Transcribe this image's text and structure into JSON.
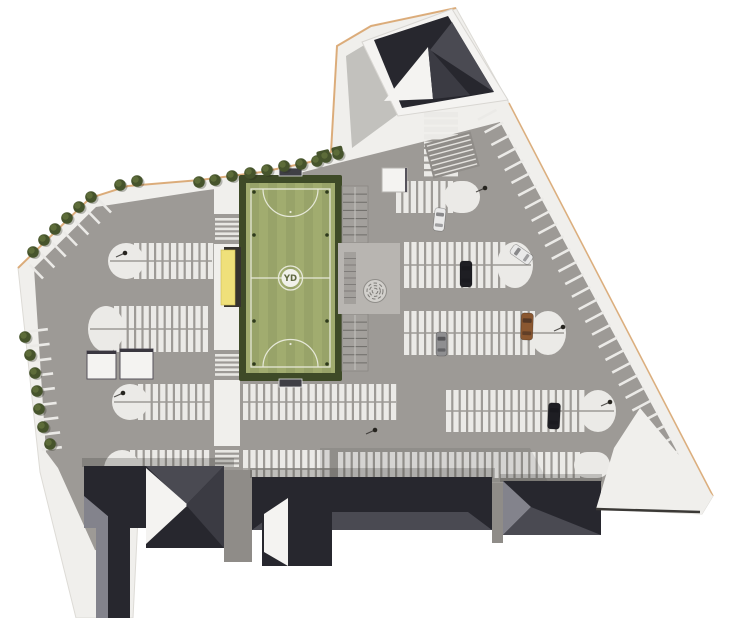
{
  "meta": {
    "description": "aerial-site-plan-rendering",
    "canvas_w": 730,
    "canvas_h": 618
  },
  "logo": {
    "text": "YD"
  },
  "palette": {
    "bg": "#ffffff",
    "sidewalk": "#f0efec",
    "asphalt": "#9d9a96",
    "asphaltDark": "#8f8c88",
    "stall": "#ebeae7",
    "fieldBorder": "#3e4a27",
    "pitch": "#a1ac6f",
    "pitchLine": "#e6e8d8",
    "treeDark": "#46542c",
    "treeLight": "#5d6c39",
    "yellow": "#efe07a",
    "canopyShadow": "#35322e",
    "roofDark": "#27272e",
    "roofMid": "#4a4a52",
    "roofDeep": "#3b3b43",
    "roofLight": "#83838c",
    "wallWhite": "#f4f3f1",
    "plaza": "#b8b5b1",
    "bleacher": "#a3a09c",
    "bleacherLine": "#6e6c68",
    "edgeTan": "#d9a268",
    "carWhite": "#e9e9e9",
    "carBlack": "#1e1e23",
    "carGray": "#8f8f91",
    "carBrown": "#8a5730",
    "pole": "#26241f"
  },
  "site": {
    "outline": [
      [
        337,
        46
      ],
      [
        371,
        26
      ],
      [
        456,
        8
      ],
      [
        509,
        103
      ],
      [
        713,
        496
      ],
      [
        702,
        514
      ],
      [
        596,
        509
      ],
      [
        332,
        498
      ],
      [
        140,
        477
      ],
      [
        133,
        618
      ],
      [
        76,
        618
      ],
      [
        40,
        472
      ],
      [
        18,
        268
      ],
      [
        90,
        198
      ],
      [
        128,
        186
      ],
      [
        200,
        180
      ],
      [
        262,
        172
      ],
      [
        310,
        162
      ],
      [
        331,
        152
      ]
    ],
    "asphalt": [
      [
        34,
        268
      ],
      [
        96,
        207
      ],
      [
        200,
        191
      ],
      [
        262,
        183
      ],
      [
        334,
        164
      ],
      [
        350,
        160
      ],
      [
        430,
        140
      ],
      [
        500,
        122
      ],
      [
        688,
        472
      ],
      [
        688,
        492
      ],
      [
        336,
        487
      ],
      [
        142,
        466
      ],
      [
        130,
        472
      ],
      [
        126,
        555
      ],
      [
        95,
        550
      ],
      [
        58,
        468
      ],
      [
        46,
        452
      ]
    ],
    "tan_edge_a": [
      [
        18,
        268
      ],
      [
        90,
        198
      ],
      [
        128,
        186
      ],
      [
        200,
        180
      ],
      [
        262,
        172
      ],
      [
        310,
        162
      ],
      [
        331,
        152
      ],
      [
        337,
        46
      ],
      [
        371,
        26
      ],
      [
        456,
        8
      ]
    ],
    "tan_edge_b": [
      [
        509,
        103
      ],
      [
        713,
        496
      ]
    ],
    "corner_wedge": [
      [
        640,
        408
      ],
      [
        713,
        496
      ],
      [
        702,
        514
      ],
      [
        596,
        509
      ],
      [
        614,
        448
      ]
    ],
    "wedge_line": [
      [
        596,
        509
      ],
      [
        700,
        512
      ]
    ]
  },
  "field": {
    "fence": [
      239,
      175,
      103,
      206
    ],
    "pitch": [
      246,
      183,
      89,
      190
    ],
    "bounds": [
      251,
      189,
      79,
      178
    ],
    "half_y": 278,
    "center": [
      290.5,
      278
    ],
    "center_r": 12,
    "logo_r": 9,
    "arc_r": 27.5,
    "goal_north": [
      279,
      168,
      23,
      8
    ],
    "goal_south": [
      279,
      379,
      23,
      8
    ],
    "spots": [
      [
        290.5,
        212
      ],
      [
        290.5,
        344
      ]
    ],
    "light_dots": [
      [
        254,
        192
      ],
      [
        327,
        192
      ],
      [
        254,
        235
      ],
      [
        327,
        235
      ],
      [
        254,
        321
      ],
      [
        327,
        321
      ],
      [
        254,
        364
      ],
      [
        327,
        364
      ]
    ]
  },
  "amenities": {
    "canopy_shadow": [
      224,
      247,
      17,
      60
    ],
    "canopy": [
      221,
      250,
      14,
      55
    ],
    "bleachers": [
      [
        342,
        186,
        26,
        57
      ],
      [
        342,
        314,
        26,
        57
      ]
    ],
    "plaza": [
      338,
      243,
      62,
      71
    ],
    "plaza_steps": [
      344,
      252,
      12,
      52
    ],
    "spiral": {
      "cx": 375,
      "cy": 291,
      "r": 11.5
    },
    "kiosks": [
      [
        87,
        351,
        29,
        28
      ],
      [
        120,
        349,
        33,
        30
      ]
    ],
    "field_kiosk": [
      382,
      168,
      25,
      24
    ],
    "hedges": [
      [
        316,
        152,
        13,
        7
      ],
      [
        331,
        148,
        11,
        6
      ]
    ]
  },
  "walkway": {
    "rect": [
      214,
      184,
      26,
      290
    ],
    "aisle_gaps": [
      [
        214,
        214,
        26,
        30
      ],
      [
        214,
        350,
        26,
        30
      ],
      [
        214,
        446,
        26,
        28
      ]
    ],
    "crosswalks": [
      [
        215,
        218,
        24,
        5
      ],
      [
        215,
        354,
        24,
        5
      ],
      [
        215,
        450,
        24,
        4
      ]
    ]
  },
  "parking": {
    "bands": [
      {
        "x": 108,
        "y": 243,
        "w": 106,
        "h": 36,
        "round": "left",
        "rows": 2
      },
      {
        "x": 88,
        "y": 306,
        "w": 126,
        "h": 46,
        "round": "left",
        "rows": 2
      },
      {
        "x": 112,
        "y": 384,
        "w": 102,
        "h": 36,
        "round": "left",
        "rows": 2
      },
      {
        "x": 241,
        "y": 384,
        "w": 157,
        "h": 36,
        "round": "none",
        "rows": 2
      },
      {
        "x": 104,
        "y": 450,
        "w": 110,
        "h": 38,
        "round": "left",
        "rows": 2
      },
      {
        "x": 241,
        "y": 450,
        "w": 91,
        "h": 38,
        "round": "none",
        "rows": 2
      },
      {
        "x": 336,
        "y": 452,
        "w": 274,
        "h": 26,
        "round": "right",
        "rows": 1
      },
      {
        "x": 394,
        "y": 181,
        "w": 86,
        "h": 32,
        "round": "right",
        "rows": 1
      },
      {
        "x": 402,
        "y": 242,
        "w": 131,
        "h": 46,
        "round": "right",
        "rows": 2
      },
      {
        "x": 402,
        "y": 311,
        "w": 164,
        "h": 44,
        "round": "right",
        "rows": 2
      },
      {
        "x": 444,
        "y": 390,
        "w": 172,
        "h": 42,
        "round": "right",
        "rows": 2
      },
      {
        "x": 424,
        "y": 112,
        "w": 34,
        "h": 66,
        "round": "none",
        "rows": 1,
        "dir": "v"
      }
    ],
    "edge_strips": [
      {
        "start": [
          500,
          108
        ],
        "end": [
          688,
          462
        ],
        "count": 29,
        "len": 21,
        "inset": 4
      },
      {
        "start": [
          27,
          262
        ],
        "end": [
          95,
          196
        ],
        "count": 7,
        "len": 19,
        "inset": 4
      },
      {
        "start": [
          24,
          332
        ],
        "end": [
          38,
          450
        ],
        "count": 9,
        "len": 20,
        "inset": 4
      }
    ]
  },
  "trees": [
    [
      33,
      252
    ],
    [
      44,
      240
    ],
    [
      55,
      229
    ],
    [
      67,
      218
    ],
    [
      79,
      207
    ],
    [
      91,
      197
    ],
    [
      120,
      185
    ],
    [
      137,
      181
    ],
    [
      199,
      182
    ],
    [
      215,
      180
    ],
    [
      232,
      176
    ],
    [
      250,
      173
    ],
    [
      267,
      170
    ],
    [
      284,
      166
    ],
    [
      301,
      164
    ],
    [
      317,
      161
    ],
    [
      326,
      157
    ],
    [
      338,
      154
    ],
    [
      25,
      337
    ],
    [
      30,
      355
    ],
    [
      35,
      373
    ],
    [
      37,
      391
    ],
    [
      39,
      409
    ],
    [
      43,
      427
    ],
    [
      50,
      444
    ]
  ],
  "poles": [
    [
      125,
      253
    ],
    [
      123,
      393
    ],
    [
      485,
      188
    ],
    [
      563,
      327
    ],
    [
      610,
      402
    ],
    [
      375,
      430
    ]
  ],
  "cars": [
    {
      "x": 434,
      "y": 208,
      "w": 11,
      "h": 23,
      "rot": 6,
      "color": "carWhite"
    },
    {
      "x": 460,
      "y": 261,
      "w": 12,
      "h": 26,
      "rot": 0,
      "color": "carBlack"
    },
    {
      "x": 516,
      "y": 243,
      "w": 11,
      "h": 23,
      "rot": -55,
      "color": "carWhite"
    },
    {
      "x": 521,
      "y": 313,
      "w": 12,
      "h": 27,
      "rot": 2,
      "color": "carBrown"
    },
    {
      "x": 436,
      "y": 332,
      "w": 11,
      "h": 24,
      "rot": 0,
      "color": "carGray"
    },
    {
      "x": 548,
      "y": 403,
      "w": 12,
      "h": 26,
      "rot": 3,
      "color": "carBlack"
    }
  ],
  "top_building": {
    "wall": [
      [
        362,
        42
      ],
      [
        452,
        9
      ],
      [
        508,
        100
      ],
      [
        398,
        116
      ]
    ],
    "roof": [
      [
        374,
        40
      ],
      [
        448,
        16
      ],
      [
        494,
        92
      ],
      [
        402,
        108
      ]
    ],
    "facet_right": [
      [
        452,
        22
      ],
      [
        494,
        92
      ],
      [
        430,
        50
      ]
    ],
    "wedge_white": [
      [
        384,
        101
      ],
      [
        428,
        47
      ],
      [
        433,
        99
      ]
    ],
    "facet_low": [
      [
        433,
        99
      ],
      [
        428,
        47
      ],
      [
        470,
        95
      ]
    ],
    "shadow": [
      [
        346,
        56
      ],
      [
        366,
        44
      ],
      [
        398,
        114
      ],
      [
        352,
        148
      ]
    ],
    "stairs": {
      "cx": 452,
      "cy": 155,
      "w": 48,
      "h": 36,
      "rot": -15,
      "steps": 7
    }
  },
  "south_buildings": {
    "gaps": [
      [
        224,
        470,
        28,
        92
      ],
      [
        492,
        483,
        11,
        60
      ]
    ],
    "shadows": [
      [
        82,
        458,
        152,
        9
      ],
      [
        250,
        468,
        245,
        10
      ],
      [
        500,
        474,
        102,
        8
      ]
    ],
    "shade_band": [
      [
        320,
        448
      ],
      [
        530,
        448
      ],
      [
        548,
        482
      ],
      [
        320,
        482
      ]
    ],
    "shapes": [
      {
        "t": "rect",
        "r": [
          84,
          466,
          86,
          62
        ],
        "f": "roofDark"
      },
      {
        "t": "poly",
        "p": [
          [
            84,
            528
          ],
          [
            84,
            496
          ],
          [
            122,
            528
          ]
        ],
        "f": "roofLight"
      },
      {
        "t": "rect",
        "r": [
          146,
          466,
          78,
          82
        ],
        "f": "roofDark"
      },
      {
        "t": "poly",
        "p": [
          [
            146,
            466
          ],
          [
            224,
            466
          ],
          [
            186,
            505
          ]
        ],
        "f": "roofMid"
      },
      {
        "t": "poly",
        "p": [
          [
            146,
            468
          ],
          [
            188,
            505
          ],
          [
            146,
            544
          ]
        ],
        "f": "wallWhite"
      },
      {
        "t": "poly",
        "p": [
          [
            224,
            466
          ],
          [
            224,
            548
          ],
          [
            186,
            505
          ]
        ],
        "f": "roofDeep"
      },
      {
        "t": "rect",
        "r": [
          96,
          516,
          34,
          102
        ],
        "f": "roofDark"
      },
      {
        "t": "rect",
        "r": [
          96,
          516,
          12,
          102
        ],
        "f": "roofLight"
      },
      {
        "t": "rect",
        "r": [
          252,
          477,
          240,
          53
        ],
        "f": "roofDark"
      },
      {
        "t": "poly",
        "p": [
          [
            252,
            530
          ],
          [
            492,
            530
          ],
          [
            468,
            512
          ],
          [
            276,
            512
          ]
        ],
        "f": "roofMid"
      },
      {
        "t": "rect",
        "r": [
          262,
          496,
          70,
          70
        ],
        "f": "roofDark"
      },
      {
        "t": "poly",
        "p": [
          [
            264,
            514
          ],
          [
            288,
            498
          ],
          [
            288,
            566
          ],
          [
            264,
            552
          ]
        ],
        "f": "wallWhite"
      },
      {
        "t": "rect",
        "r": [
          503,
          481,
          98,
          54
        ],
        "f": "roofDark"
      },
      {
        "t": "poly",
        "p": [
          [
            503,
            481
          ],
          [
            531,
            507
          ],
          [
            503,
            535
          ]
        ],
        "f": "roofLight"
      },
      {
        "t": "poly",
        "p": [
          [
            503,
            535
          ],
          [
            531,
            507
          ],
          [
            601,
            535
          ]
        ],
        "f": "roofMid"
      }
    ]
  }
}
